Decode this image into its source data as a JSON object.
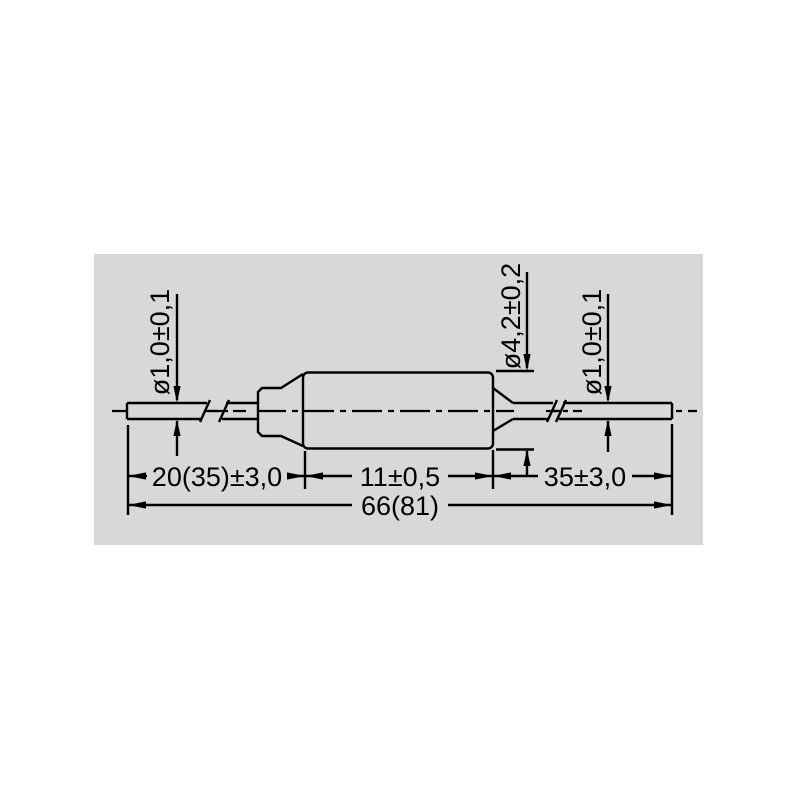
{
  "drawing": {
    "panel_color": "#d8d8d8",
    "line_color": "#000000",
    "labels": {
      "lead_left_diameter": "ø1,0±0,1",
      "body_diameter": "ø4,2±0,2",
      "lead_right_diameter": "ø1,0±0,1",
      "lead_left_length": "20(35)±3,0",
      "body_length": "11±0,5",
      "lead_right_length": "35±3,0",
      "overall_length": "66(81)"
    }
  }
}
